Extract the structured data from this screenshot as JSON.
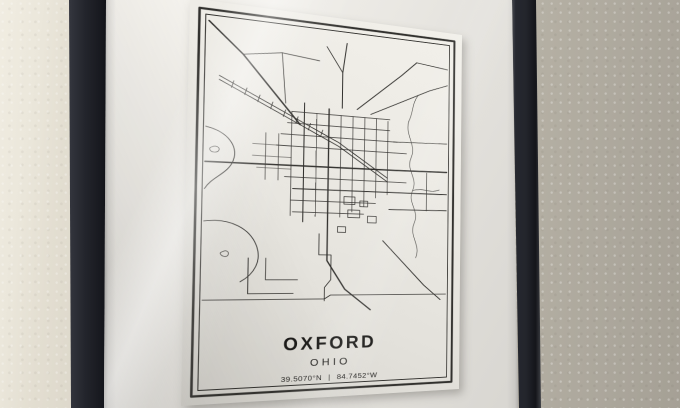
{
  "poster": {
    "title": "OXFORD",
    "subtitle": "OHIO",
    "latitude": "39.5070°N",
    "separator": "|",
    "longitude": "84.7452°W"
  },
  "colors": {
    "wall_left": "#ebe7db",
    "wall_right": "#aba69b",
    "frame": "#23252c",
    "mat": "#efede8",
    "paper": "#eceae4",
    "map_line": "#32312e",
    "ink": "#1b1a18"
  },
  "map": {
    "paths": [
      {
        "d": "M17,20 L48,50 L102,117",
        "w": 1.5
      },
      {
        "d": "M27,74 L140,133 L190,168",
        "w": 0.8
      },
      {
        "d": "M27,78 L140,137 L190,172",
        "w": 0.8
      },
      {
        "d": "M40,78 L38,85 M52,84 L50,91 M64,90 L62,97 M76,96 L74,103 M88,103 L86,110 M100,109 L98,116 M112,115 L110,122 M124,121 L122,128",
        "w": 0.7
      },
      {
        "d": "M16,161 L100,160 L200,159 L254,158",
        "w": 1.5
      },
      {
        "d": "M96,184 L254,183",
        "w": 1.1
      },
      {
        "d": "M192,202 L254,201",
        "w": 0.9
      },
      {
        "d": "M130,98 L130,218 L130,258 L148,288 L174,310",
        "w": 1.3
      },
      {
        "d": "M106,94 L106,218",
        "w": 1.0
      },
      {
        "d": "M143,96 L143,58 L147,26",
        "w": 1.0
      },
      {
        "d": "M143,58 L127,32",
        "w": 0.8
      },
      {
        "d": "M158,96 L204,54 L220,38",
        "w": 0.9
      },
      {
        "d": "M172,100 L234,68 L254,60",
        "w": 0.8
      },
      {
        "d": "M220,38 L254,42",
        "w": 0.8
      },
      {
        "d": "M94,104 L94,212",
        "w": 0.65
      },
      {
        "d": "M118,104 L118,212",
        "w": 0.65
      },
      {
        "d": "M142,104 L142,212",
        "w": 0.65
      },
      {
        "d": "M154,104 L154,206",
        "w": 0.65
      },
      {
        "d": "M166,104 L166,200",
        "w": 0.65
      },
      {
        "d": "M178,104 L178,190",
        "w": 0.65
      },
      {
        "d": "M190,106 L190,186",
        "w": 0.65
      },
      {
        "d": "M94,104 L192,104",
        "w": 0.65
      },
      {
        "d": "M90,116 L192,116",
        "w": 0.65
      },
      {
        "d": "M84,128 L200,128",
        "w": 0.65
      },
      {
        "d": "M80,140 L210,140",
        "w": 0.65
      },
      {
        "d": "M88,172 L210,172",
        "w": 0.65
      },
      {
        "d": "M94,196 L178,196",
        "w": 0.65
      },
      {
        "d": "M96,208 L166,208",
        "w": 0.65
      },
      {
        "d": "M58,140 L94,140 M58,152 L94,152 M62,164 L94,164",
        "w": 0.6
      },
      {
        "d": "M70,128 L70,176 M82,128 L82,176",
        "w": 0.6
      },
      {
        "d": "M146,190 h11 v8 h-11 z M162,194 h8 v6 h-8 z M150,204 h12 v8 h-12 z M170,210 h9 v7 h-9 z M140,222 h8 v6 h-8 z",
        "w": 0.7
      },
      {
        "d": "M212,104 C208,120 221,130 215,144 C209,158 223,166 217,180 C211,194 225,202 219,216 C213,230 227,240 221,254",
        "w": 0.55
      },
      {
        "d": "M212,104 C217,94 215,84 222,74",
        "w": 0.55
      },
      {
        "d": "M217,180 C229,176 236,183 246,178",
        "w": 0.55
      },
      {
        "d": "M16,126 C36,130 45,144 41,158 C37,172 22,176 16,188",
        "w": 0.8
      },
      {
        "d": "M16,220 C40,216 57,227 63,243 C69,259 61,273 49,280",
        "w": 0.8
      },
      {
        "d": "M22,146 c3,-2 7,0 6,3 c-1,3 -7,3 -8,0 c-0.5,-1.5 0,-2 2,-3 z",
        "w": 0.6
      },
      {
        "d": "M33,250 c3,-2 6,0 5,3 c-1,3 -6,2 -7,-1 c0,-1 0,-1 2,-2 z",
        "w": 0.6
      },
      {
        "d": "M56,256 L56,292 L98,292",
        "w": 0.85
      },
      {
        "d": "M72,256 L72,278 L102,278",
        "w": 0.7
      },
      {
        "d": "M186,236 L230,284 L248,300",
        "w": 0.95
      },
      {
        "d": "M122,230 L122,252 L134,252 L134,278 L128,286 L128,300",
        "w": 0.8
      },
      {
        "d": "M16,298 L128,298 L134,294 L254,294",
        "w": 0.8
      },
      {
        "d": "M48,50 L84,44 L120,48",
        "w": 0.8
      },
      {
        "d": "M84,44 L88,96",
        "w": 0.7
      },
      {
        "d": "M196,128 L254,126",
        "w": 0.7
      },
      {
        "d": "M232,160 L232,202",
        "w": 0.7
      }
    ]
  }
}
